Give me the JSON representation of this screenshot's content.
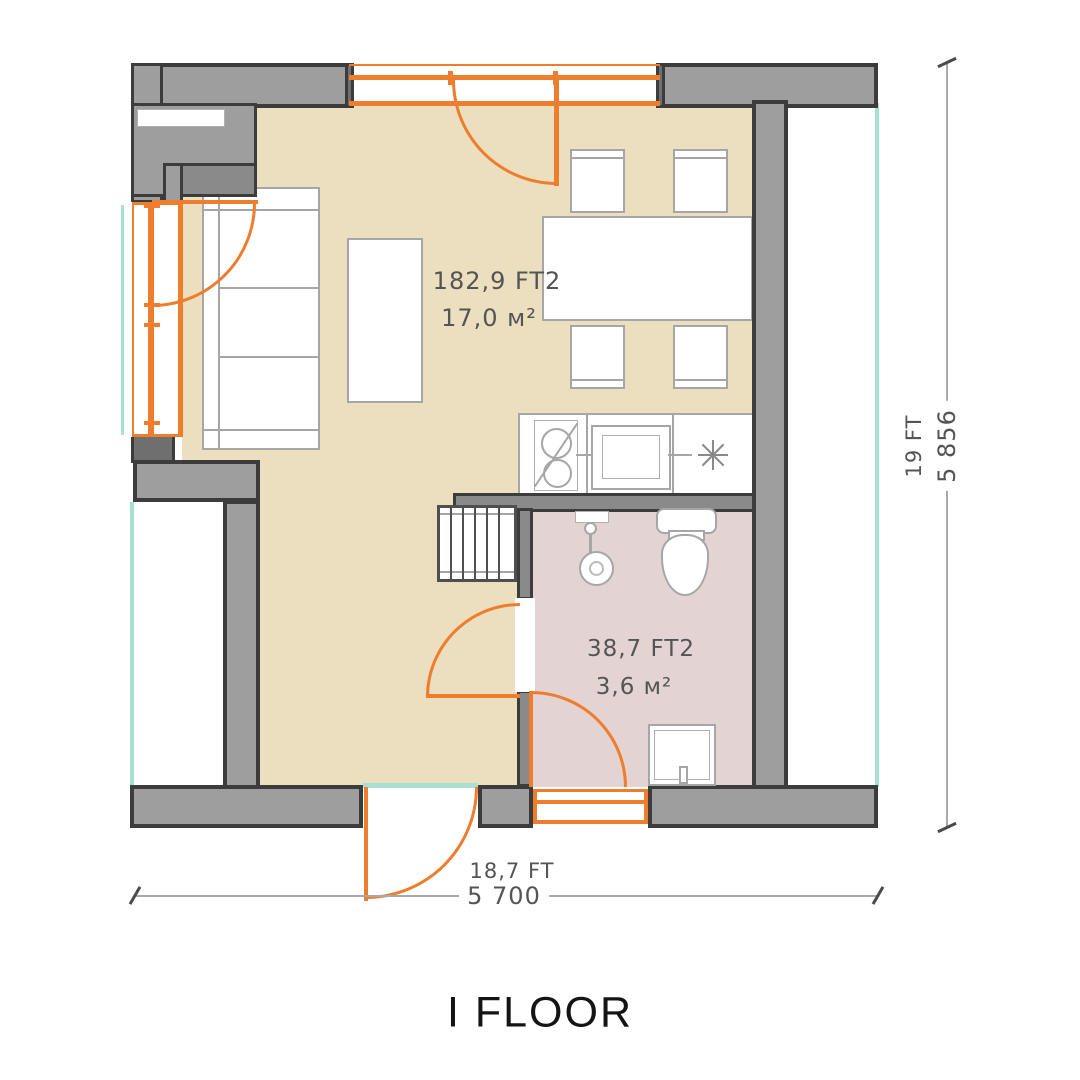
{
  "title": "I FLOOR",
  "rooms": {
    "living_room": {
      "area_imperial": "182,9 FT2",
      "area_metric": "17,0 м²"
    },
    "bathroom": {
      "area_imperial": "38,7 FT2",
      "area_metric": "3,6 м²"
    }
  },
  "dimensions": {
    "horizontal": {
      "feet": "18,7 FT",
      "millimeters": "5 700"
    },
    "vertical": {
      "feet": "19 FT",
      "millimeters": "5 856"
    }
  },
  "colors": {
    "accent_orange": "#ee7d2e",
    "floor_living": "#ecdfc0",
    "floor_bathroom": "#e3d3d3",
    "wall_fill": "#9e9e9e",
    "wall_outline": "#3c3c3c",
    "threshold_teal": "#a9ded2",
    "dimension_gray": "#a9a9a9",
    "label_gray": "#545454"
  },
  "icons": {
    "kitchen_star": "8-point-asterisk"
  }
}
